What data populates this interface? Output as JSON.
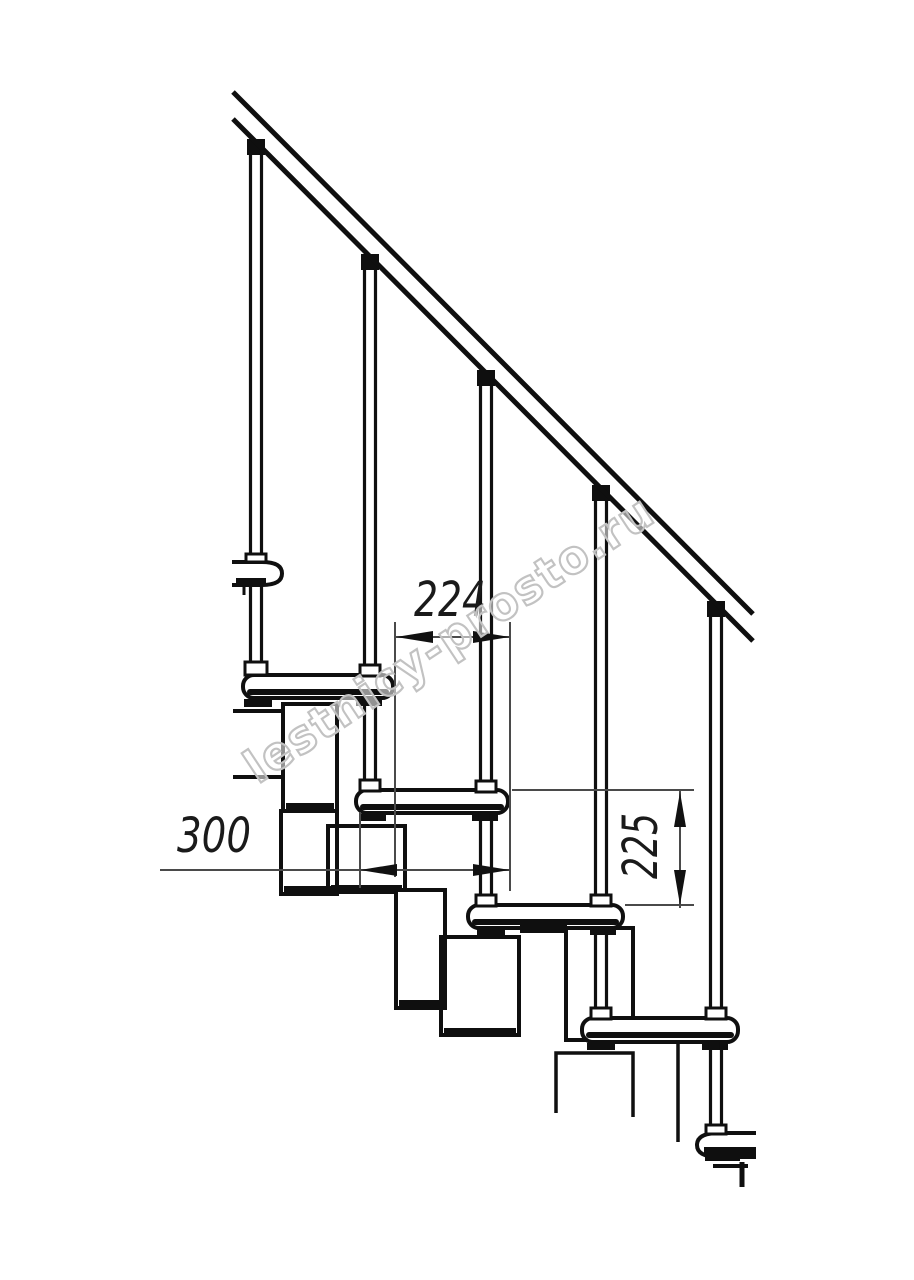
{
  "drawing": {
    "subject": "modular staircase side elevation",
    "watermark": {
      "text": "lestnicy-prosto.ru"
    },
    "dimensions": {
      "step_run": {
        "label": "224",
        "orientation": "horizontal"
      },
      "tread_depth": {
        "label": "300",
        "orientation": "horizontal"
      },
      "step_height": {
        "label": "225",
        "orientation": "vertical"
      }
    },
    "colors": {
      "background": "#ffffff",
      "line": "#0f0f0f",
      "dimension_line": "#4a4a4a",
      "dimension_text": "#1a1a1a",
      "watermark_outline": "#c2c2c2"
    }
  }
}
